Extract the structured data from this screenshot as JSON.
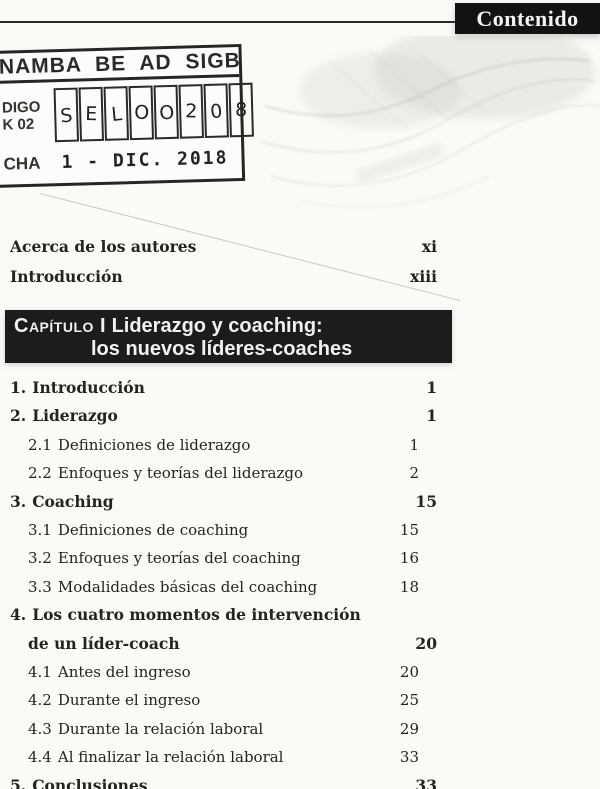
{
  "page": {
    "header": {
      "title": "Contenido"
    },
    "stamp": {
      "title": "NAMBA BE AD SIGB",
      "code_label_line1": "DIGO",
      "code_label_line2": "K 02",
      "code_cells": [
        "S",
        "E",
        "L",
        "O",
        "O",
        "2",
        "0",
        "8"
      ],
      "date_label": "CHA",
      "date": "1 - DIC. 2018"
    },
    "front_matter": [
      {
        "label": "Acerca de los autores",
        "page": "xi"
      },
      {
        "label": "Introducción",
        "page": "xiii"
      }
    ],
    "chapter": {
      "label": "Capítulo I",
      "title_line1": "Liderazgo y coaching:",
      "title_line2": "los nuevos líderes-coaches"
    },
    "toc": [
      {
        "num": "1.",
        "text": "Introducción",
        "page": "1",
        "level": 1
      },
      {
        "num": "2.",
        "text": "Liderazgo",
        "page": "1",
        "level": 1
      },
      {
        "num": "2.1",
        "text": "Definiciones de liderazgo",
        "page": "1",
        "level": 2
      },
      {
        "num": "2.2",
        "text": "Enfoques y teorías del liderazgo",
        "page": "2",
        "level": 2
      },
      {
        "num": "3.",
        "text": "Coaching",
        "page": "15",
        "level": 1
      },
      {
        "num": "3.1",
        "text": "Definiciones de coaching",
        "page": "15",
        "level": 2
      },
      {
        "num": "3.2",
        "text": "Enfoques y teorías del coaching",
        "page": "16",
        "level": 2
      },
      {
        "num": "3.3",
        "text": "Modalidades básicas del coaching",
        "page": "18",
        "level": 2
      },
      {
        "num": "4.",
        "text": "Los cuatro momentos de intervención",
        "text2": "de un líder-coach",
        "page": "20",
        "level": 1
      },
      {
        "num": "4.1",
        "text": "Antes del ingreso",
        "page": "20",
        "level": 2
      },
      {
        "num": "4.2",
        "text": "Durante el ingreso",
        "page": "25",
        "level": 2
      },
      {
        "num": "4.3",
        "text": "Durante la relación laboral",
        "page": "29",
        "level": 2
      },
      {
        "num": "4.4",
        "text": "Al finalizar la relación laboral",
        "page": "33",
        "level": 2
      },
      {
        "num": "5.",
        "text": "Conclusiones",
        "page": "33",
        "level": 1
      }
    ],
    "colors": {
      "header_bg": "#121212",
      "chapter_bg": "#1c1c1c",
      "paper": "#fbfaf7",
      "ink": "#26231f"
    }
  }
}
